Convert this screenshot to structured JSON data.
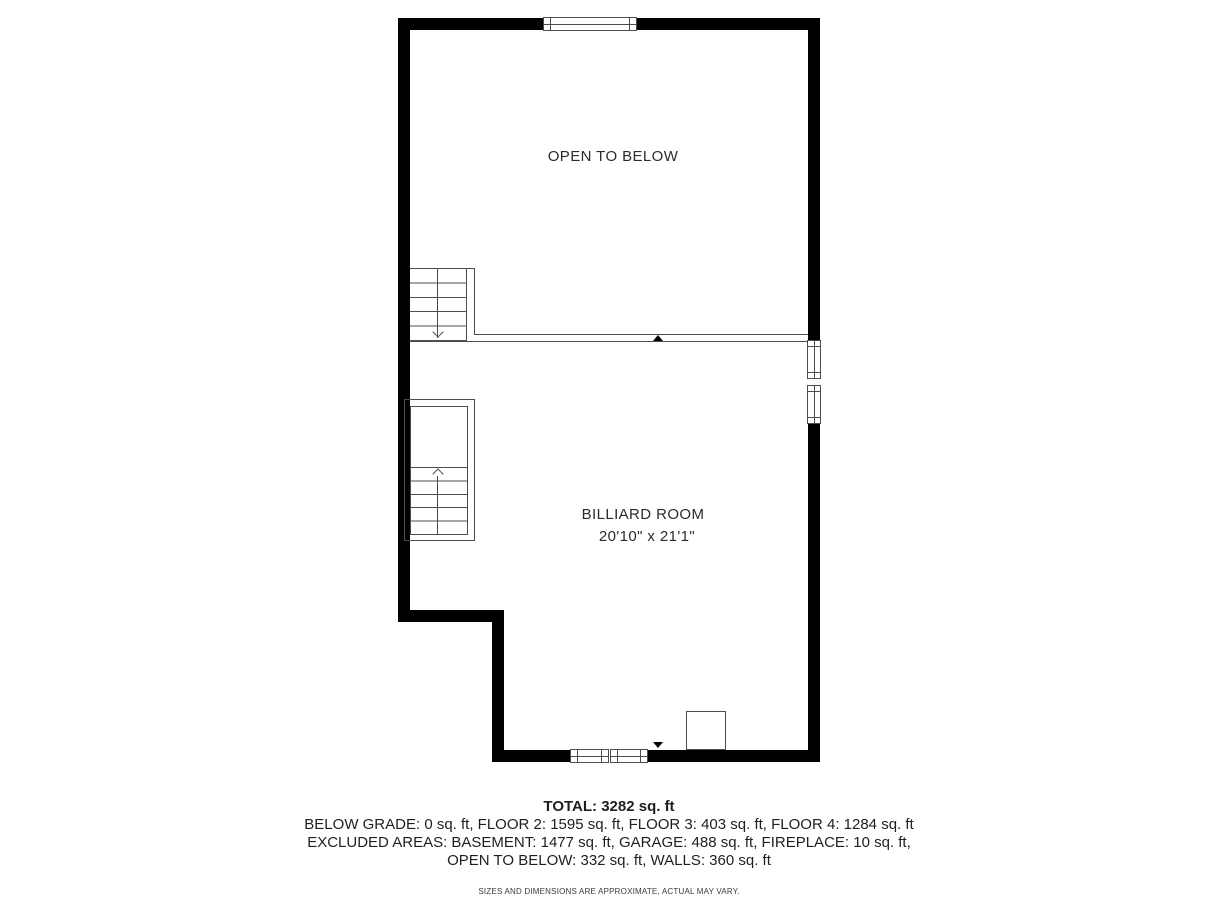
{
  "plan": {
    "open_to_below_label": "OPEN TO BELOW",
    "billiard_room": {
      "label": "BILLIARD ROOM",
      "dimensions": "20'10\" x 21'1\""
    }
  },
  "summary": {
    "total": "TOTAL: 3282 sq. ft",
    "floors": "BELOW GRADE: 0 sq. ft, FLOOR 2: 1595 sq. ft, FLOOR 3: 403 sq. ft, FLOOR 4: 1284 sq. ft",
    "excluded1": "EXCLUDED AREAS: BASEMENT: 1477 sq. ft, GARAGE: 488 sq. ft, FIREPLACE: 10 sq. ft,",
    "excluded2": "OPEN TO BELOW: 332 sq. ft, WALLS: 360 sq. ft",
    "disclaimer": "SIZES AND DIMENSIONS ARE APPROXIMATE, ACTUAL MAY VARY."
  },
  "colors": {
    "wall": "#000000",
    "thin_line": "#4d4d4d",
    "text": "#1f1f1f"
  }
}
